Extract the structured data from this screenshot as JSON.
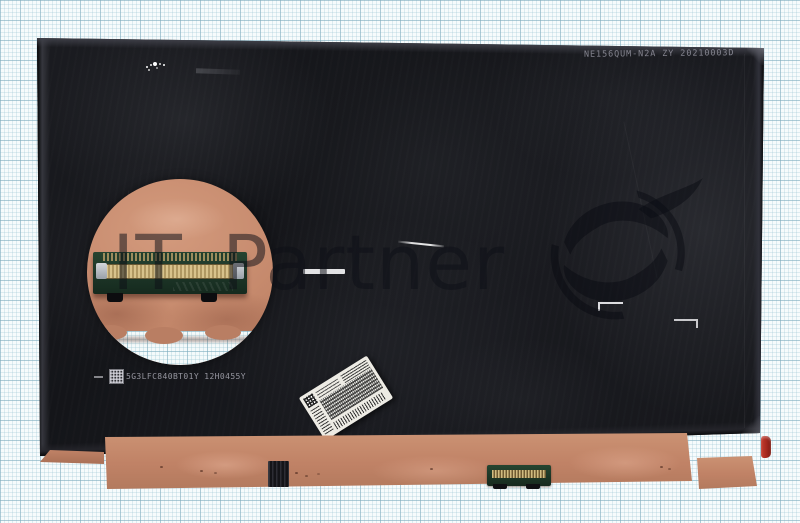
{
  "scene": {
    "description": "Rear-side product photo of a bare laptop LCD screen panel lying on light blue millimeter graph paper",
    "type": "product-photo"
  },
  "watermark": {
    "text": "IT Partner",
    "logo": "s-swoosh-emblem"
  },
  "panel": {
    "top_marking": "NE156QUM-N2A ZY 20210003D",
    "serial_marking": "5G3LFC840BT01Y 12H0455Y",
    "features": [
      "circular-closeup-of-40pin-edp-connector",
      "white-barcode-sticker",
      "copper-foil-bottom-strip",
      "edp-socket-on-bottom-edge",
      "red-pull-tab"
    ]
  },
  "icons": {
    "qr_code": "qr-code-icon"
  },
  "colors": {
    "paper": "#f6fbfc",
    "grid_minor": "#cfe5ec",
    "grid_major": "#9ec6d4",
    "panel": "#17181d",
    "copper": "#c08266",
    "pcb_green": "#1d3527",
    "gold_pins": "#c9ab6e",
    "red_tab": "#a5281e",
    "sticker": "#edebe4"
  }
}
